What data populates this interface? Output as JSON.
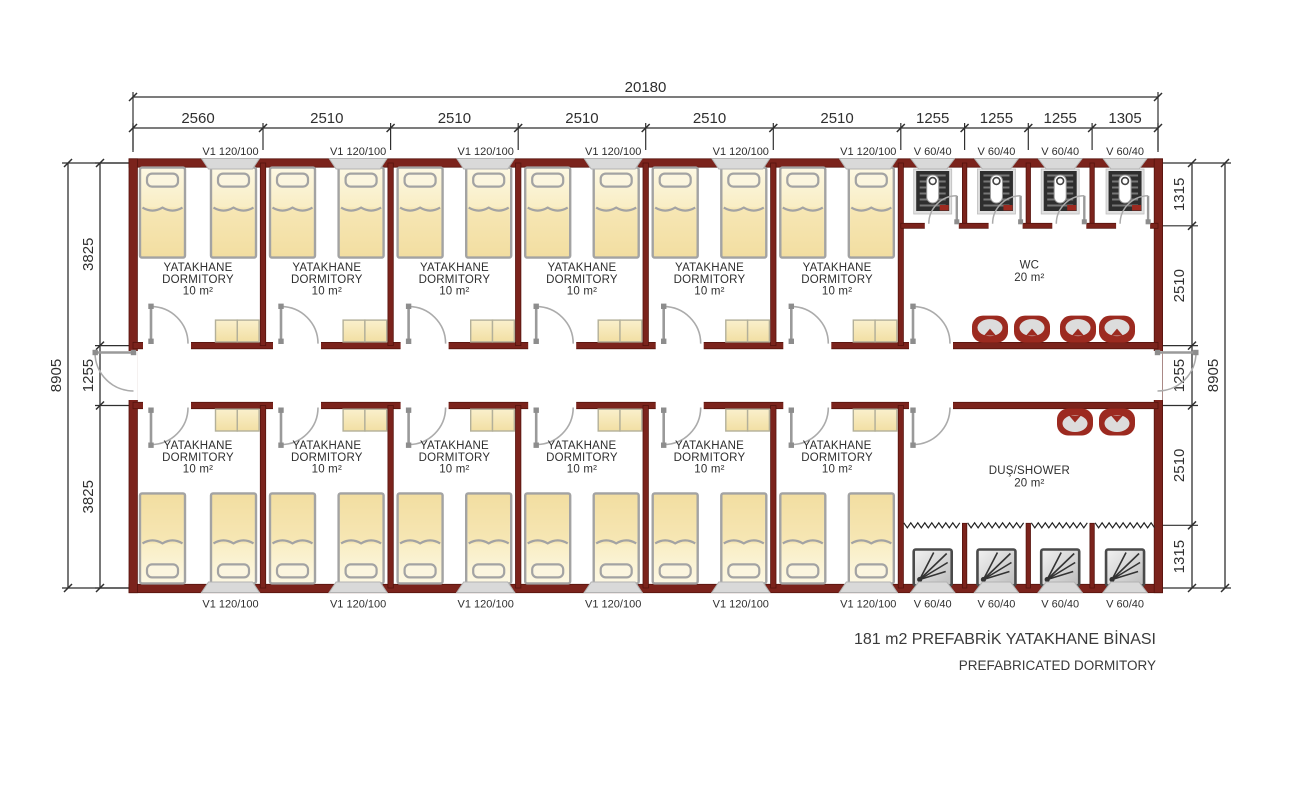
{
  "title": {
    "line1": "181 m2 PREFABRİK YATAKHANE BİNASI",
    "line2": "PREFABRICATED DORMITORY"
  },
  "dimensions": {
    "top_total": "20180",
    "top_segments": [
      "2560",
      "2510",
      "2510",
      "2510",
      "2510",
      "2510",
      "1255",
      "1255",
      "1255",
      "1305"
    ],
    "left_total": "8905",
    "left_segments": [
      "3825",
      "1255",
      "3825"
    ],
    "right_total": "8905",
    "right_segments": [
      "1315",
      "2510",
      "1255",
      "2510",
      "1315"
    ]
  },
  "window_labels": {
    "top": [
      "V1 120/100",
      "V1 120/100",
      "V1 120/100",
      "V1 120/100",
      "V1 120/100",
      "V1 120/100",
      "V 60/40",
      "V 60/40",
      "V 60/40",
      "V 60/40"
    ],
    "bottom": [
      "V1 120/100",
      "V1 120/100",
      "V1 120/100",
      "V1 120/100",
      "V1 120/100",
      "V1 120/100",
      "V 60/40",
      "V 60/40",
      "V 60/40",
      "V 60/40"
    ]
  },
  "room_labels": {
    "dormitory": {
      "line1": "YATAKHANE",
      "line2": "DORMITORY",
      "line3": "10 m²"
    },
    "wc": {
      "line1": "WC",
      "line2": "20 m²"
    },
    "shower": {
      "line1": "DUŞ/SHOWER",
      "line2": "20 m²"
    }
  },
  "colors": {
    "wall": "#7b231c",
    "wall_edge": "#55130d",
    "dim_line": "#2f2f2f",
    "bed_border": "#a3a3a3",
    "bed_fill_light": "#fdf8e3",
    "bed_fill_deep": "#f1dc9c",
    "pillow_fill": "#fbf5df",
    "cabinet_border": "#b3b09a",
    "door": "#9a9a9a",
    "door_hw": "#8d8d8d",
    "window": "#d9d9d9",
    "window_edge": "#b3b3b3",
    "fixture_red": "#9c2a20",
    "fixture_gray": "#dcdcdc",
    "toilet_dark": "#2e2e2e",
    "tray_edge": "#4a4a4a"
  }
}
